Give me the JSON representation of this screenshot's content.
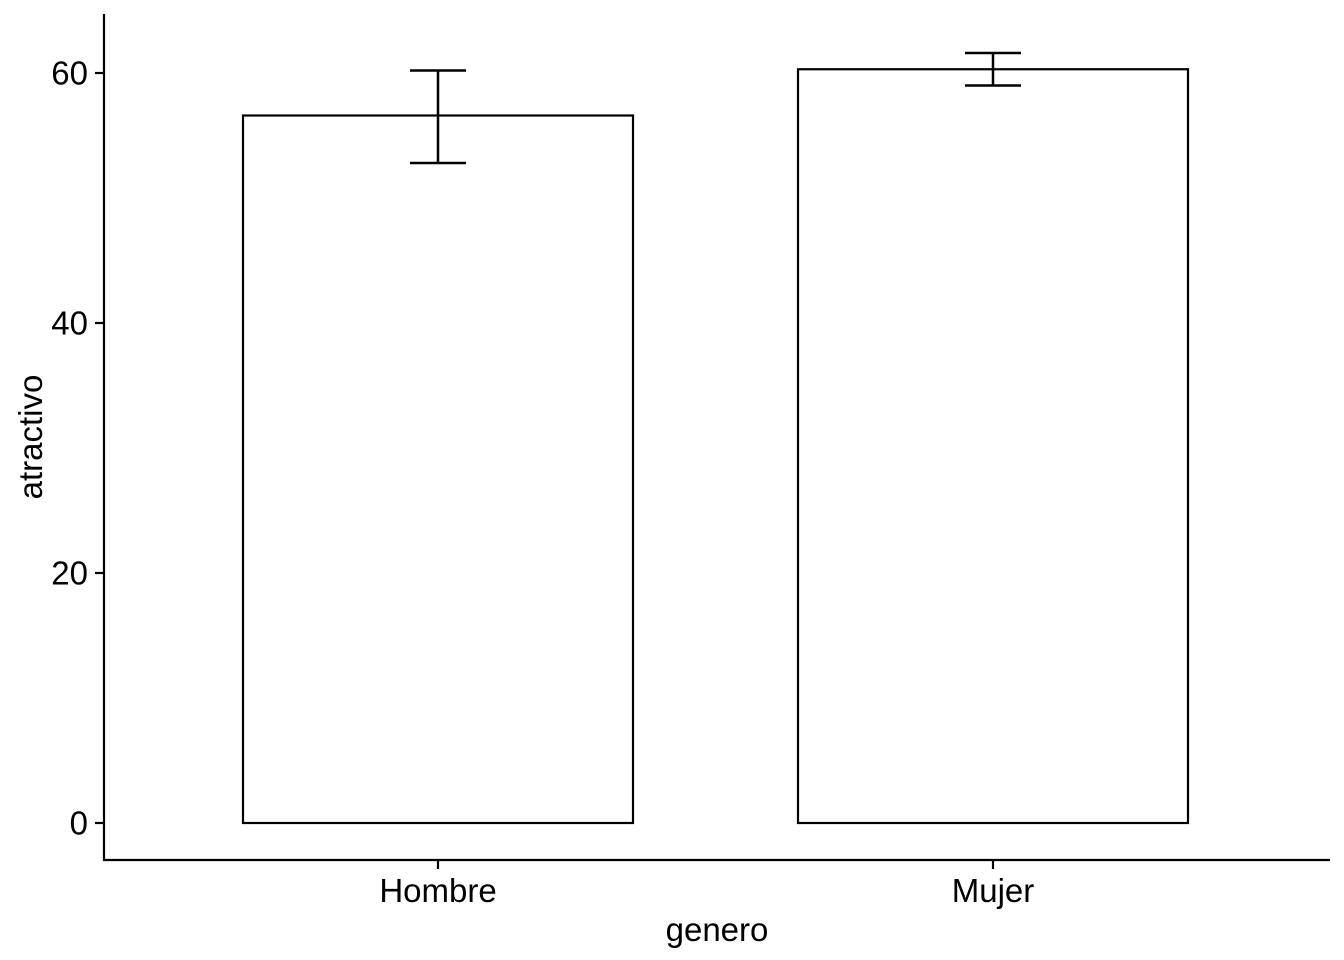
{
  "chart": {
    "background_color": "#FFFFFF",
    "foreground_color": "#000000"
  },
  "chart_data": {
    "type": "bar",
    "title": "",
    "xlabel": "genero",
    "ylabel": "atractivo",
    "categories": [
      "Hombre",
      "Mujer"
    ],
    "series": [
      {
        "name": "atractivo",
        "values": [
          56.6,
          60.3
        ]
      }
    ],
    "error_bars": [
      {
        "category": "Hombre",
        "low": 52.8,
        "high": 60.2
      },
      {
        "category": "Mujer",
        "low": 59.0,
        "high": 61.6
      }
    ],
    "yticks": [
      0,
      20,
      40,
      60
    ],
    "ylim": [
      -3.1,
      64.7
    ],
    "grid": "off",
    "legend": "none",
    "bar_fill": "#FFFFFF",
    "bar_stroke": "#000000",
    "axis_color": "#000000"
  }
}
